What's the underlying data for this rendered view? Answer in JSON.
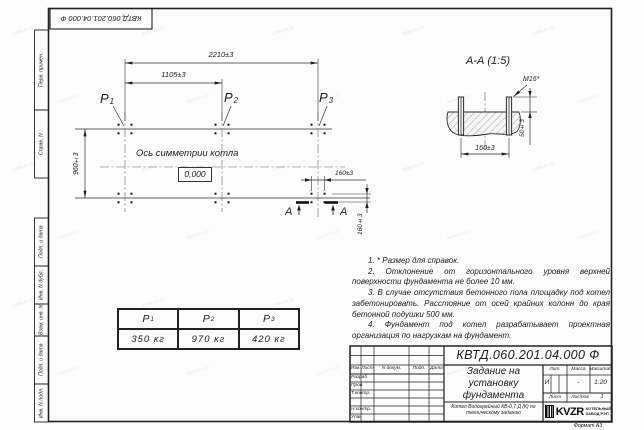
{
  "stamp_top": "КВТД.060.201.04.000  Ф",
  "side_labels": [
    "Перв. примен.",
    "Справ. N",
    "Подп. и дата",
    "Инв. N дубл.",
    "Взам. инв. N",
    "Подп. и дата",
    "Инв. N подл."
  ],
  "plan": {
    "dim_width_total": "2210±3",
    "dim_width_half": "1105±3",
    "dim_height": "960±3",
    "dim_bolt_h": "160±3",
    "dim_bolt_v": "160±3",
    "axis_label": "Ось симметрии котла",
    "elevation": "0,000",
    "points": [
      {
        "name": "P",
        "sub": "1"
      },
      {
        "name": "P",
        "sub": "2"
      },
      {
        "name": "P",
        "sub": "3"
      }
    ],
    "section_mark": "А"
  },
  "section": {
    "title": "А-А (1:5)",
    "bolt_label": "M16*",
    "dim_height": "50±3",
    "dim_width": "160±3"
  },
  "notes": [
    "1. * Размер для справок.",
    "2. Отклонение от горизонтального уровня верхней поверхности фундамента не более 10 мм.",
    "3. В случае отсутствия бетонного пола площадку под котел забетонировать. Расстояние от осей крайних колонн до края бетонной подушки 500 мм.",
    "4. Фундамент под котел разрабатывает проектная организация по нагрузкам на фундамент."
  ],
  "load_table": {
    "headers": [
      {
        "name": "P",
        "sub": "1"
      },
      {
        "name": "P",
        "sub": "2"
      },
      {
        "name": "P",
        "sub": "3"
      }
    ],
    "values": [
      "350 кг",
      "970 кг",
      "420 кг"
    ]
  },
  "title_block": {
    "designation": "КВТД.060.201.04.000  Ф",
    "title_lines": [
      "Задание на",
      "установку",
      "фундамента"
    ],
    "columns": [
      "Изм.",
      "Лист",
      "N докум.",
      "Подп.",
      "Дата"
    ],
    "rows": [
      "Разраб.",
      "Пров.",
      "Т.контр.",
      "Н.контр.",
      "Утв."
    ],
    "lit_label": "Лит.",
    "lit_value": "И",
    "mass_label": "Масса",
    "mass_value": "-",
    "scale_label": "Масштаб",
    "scale_value": "1:20",
    "sheet_label": "Лист",
    "sheets_label": "Листов",
    "sheets_value": "1",
    "product": "Котел Водогрейный КВ-0,7 Д (К) по техническому заданию",
    "company_logo": "KVZR",
    "company_name_lines": [
      "КОТЕЛЬНЫЙ",
      "ЗАВОД РЭП"
    ],
    "format_label": "Формат А3"
  },
  "watermark": "kotel-kv.ru",
  "colors": {
    "line": "#2a2a2a",
    "faint": "#666666"
  }
}
